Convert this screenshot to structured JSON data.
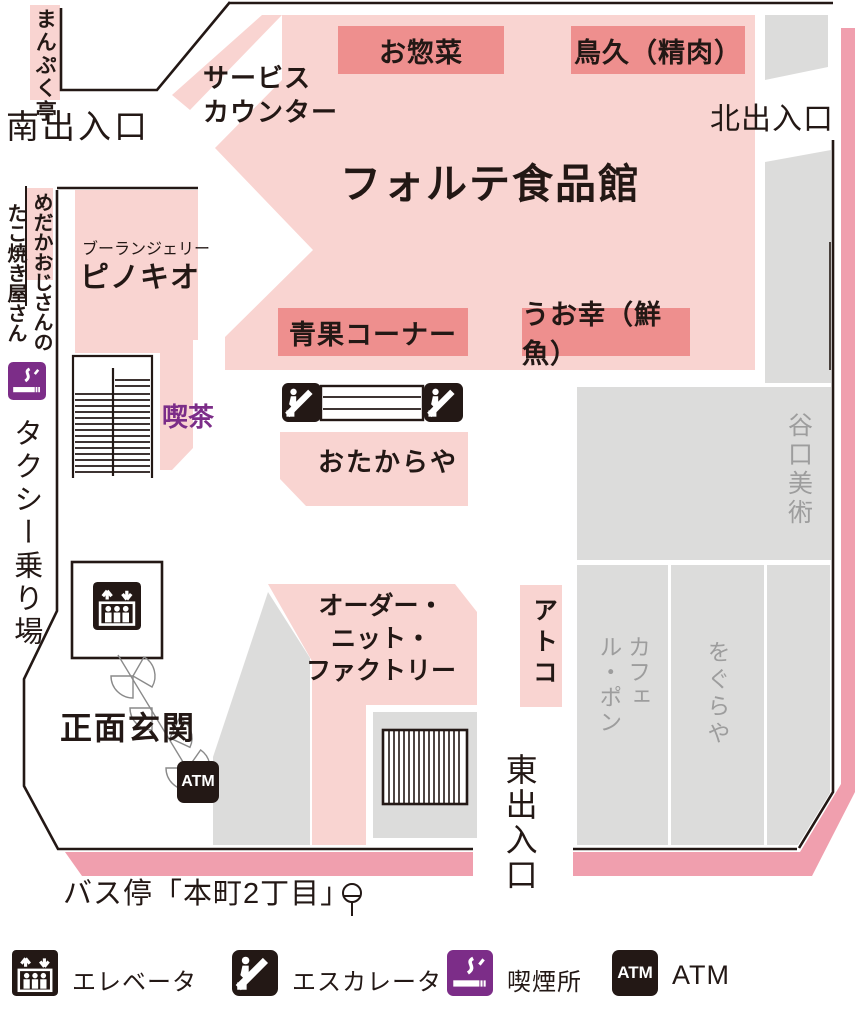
{
  "map": {
    "building_title": "フォルテ食品館",
    "entrances": {
      "south": "南出入口",
      "north": "北出入口",
      "east": "東出入口",
      "main": "正面玄関"
    },
    "exterior": {
      "manpukutei": "まんぷく亭",
      "takoyaki_owner": "めだかおじさんの",
      "takoyaki_shop": "たこ焼き屋さん",
      "taxi_stand": "タクシー乗り場",
      "bus_stop": "バス停「本町2丁目」"
    },
    "departments": {
      "souzai": "お惣菜",
      "torikyu": "鳥久（精肉）",
      "seika": "青果コーナー",
      "uokou": "うお幸（鮮魚）"
    },
    "shops": {
      "pinokio_sub": "ブーランジェリー",
      "pinokio": "ピノキオ",
      "kissa": "喫茶",
      "otakaraya": "おたからや",
      "order_knit": "オーダー・\nニット・\nファクトリー",
      "atoko": "アトコ",
      "taniguchi": "谷口美術",
      "cafe_le_pon": "カフェ\nル・ポン",
      "oguraya": "をぐらや"
    },
    "service_counter": "サービス\nカウンター",
    "atm_icon_label": "ATM"
  },
  "legend": {
    "elevator": "エレベータ",
    "escalator": "エスカレータ",
    "smoking": "喫煙所",
    "atm": "ATM",
    "atm_icon_label": "ATM"
  },
  "colors": {
    "hall_pink": "#f9d4d1",
    "label_salmon": "#ee8f8e",
    "road_rose": "#f09fae",
    "gray_area": "#dcdcdb",
    "gray_text": "#9d9d9d",
    "smoking_purple": "#7c2d88",
    "ink": "#231815"
  }
}
